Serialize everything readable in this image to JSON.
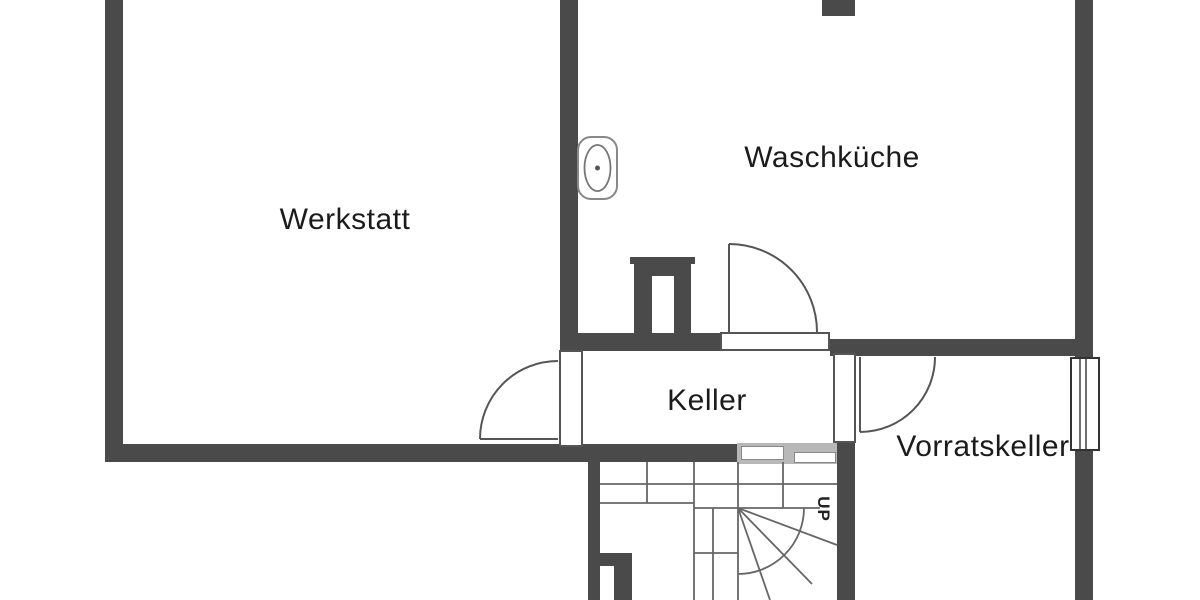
{
  "plan": {
    "rooms": [
      {
        "id": "werkstatt",
        "label": "Werkstatt"
      },
      {
        "id": "waschkueche",
        "label": "Waschküche"
      },
      {
        "id": "keller",
        "label": "Keller"
      },
      {
        "id": "vorratskeller",
        "label": "Vorratskeller"
      }
    ],
    "stairs": {
      "direction_label": "UP"
    }
  },
  "colors": {
    "background": "#ffffff",
    "wall": "#4a4a4a",
    "door_line": "#555555",
    "stair_line": "#666666",
    "fixture_line": "#888888",
    "railing_fill": "#b8b8b8",
    "window_frame": "#333333",
    "text": "#1b1b1b"
  }
}
